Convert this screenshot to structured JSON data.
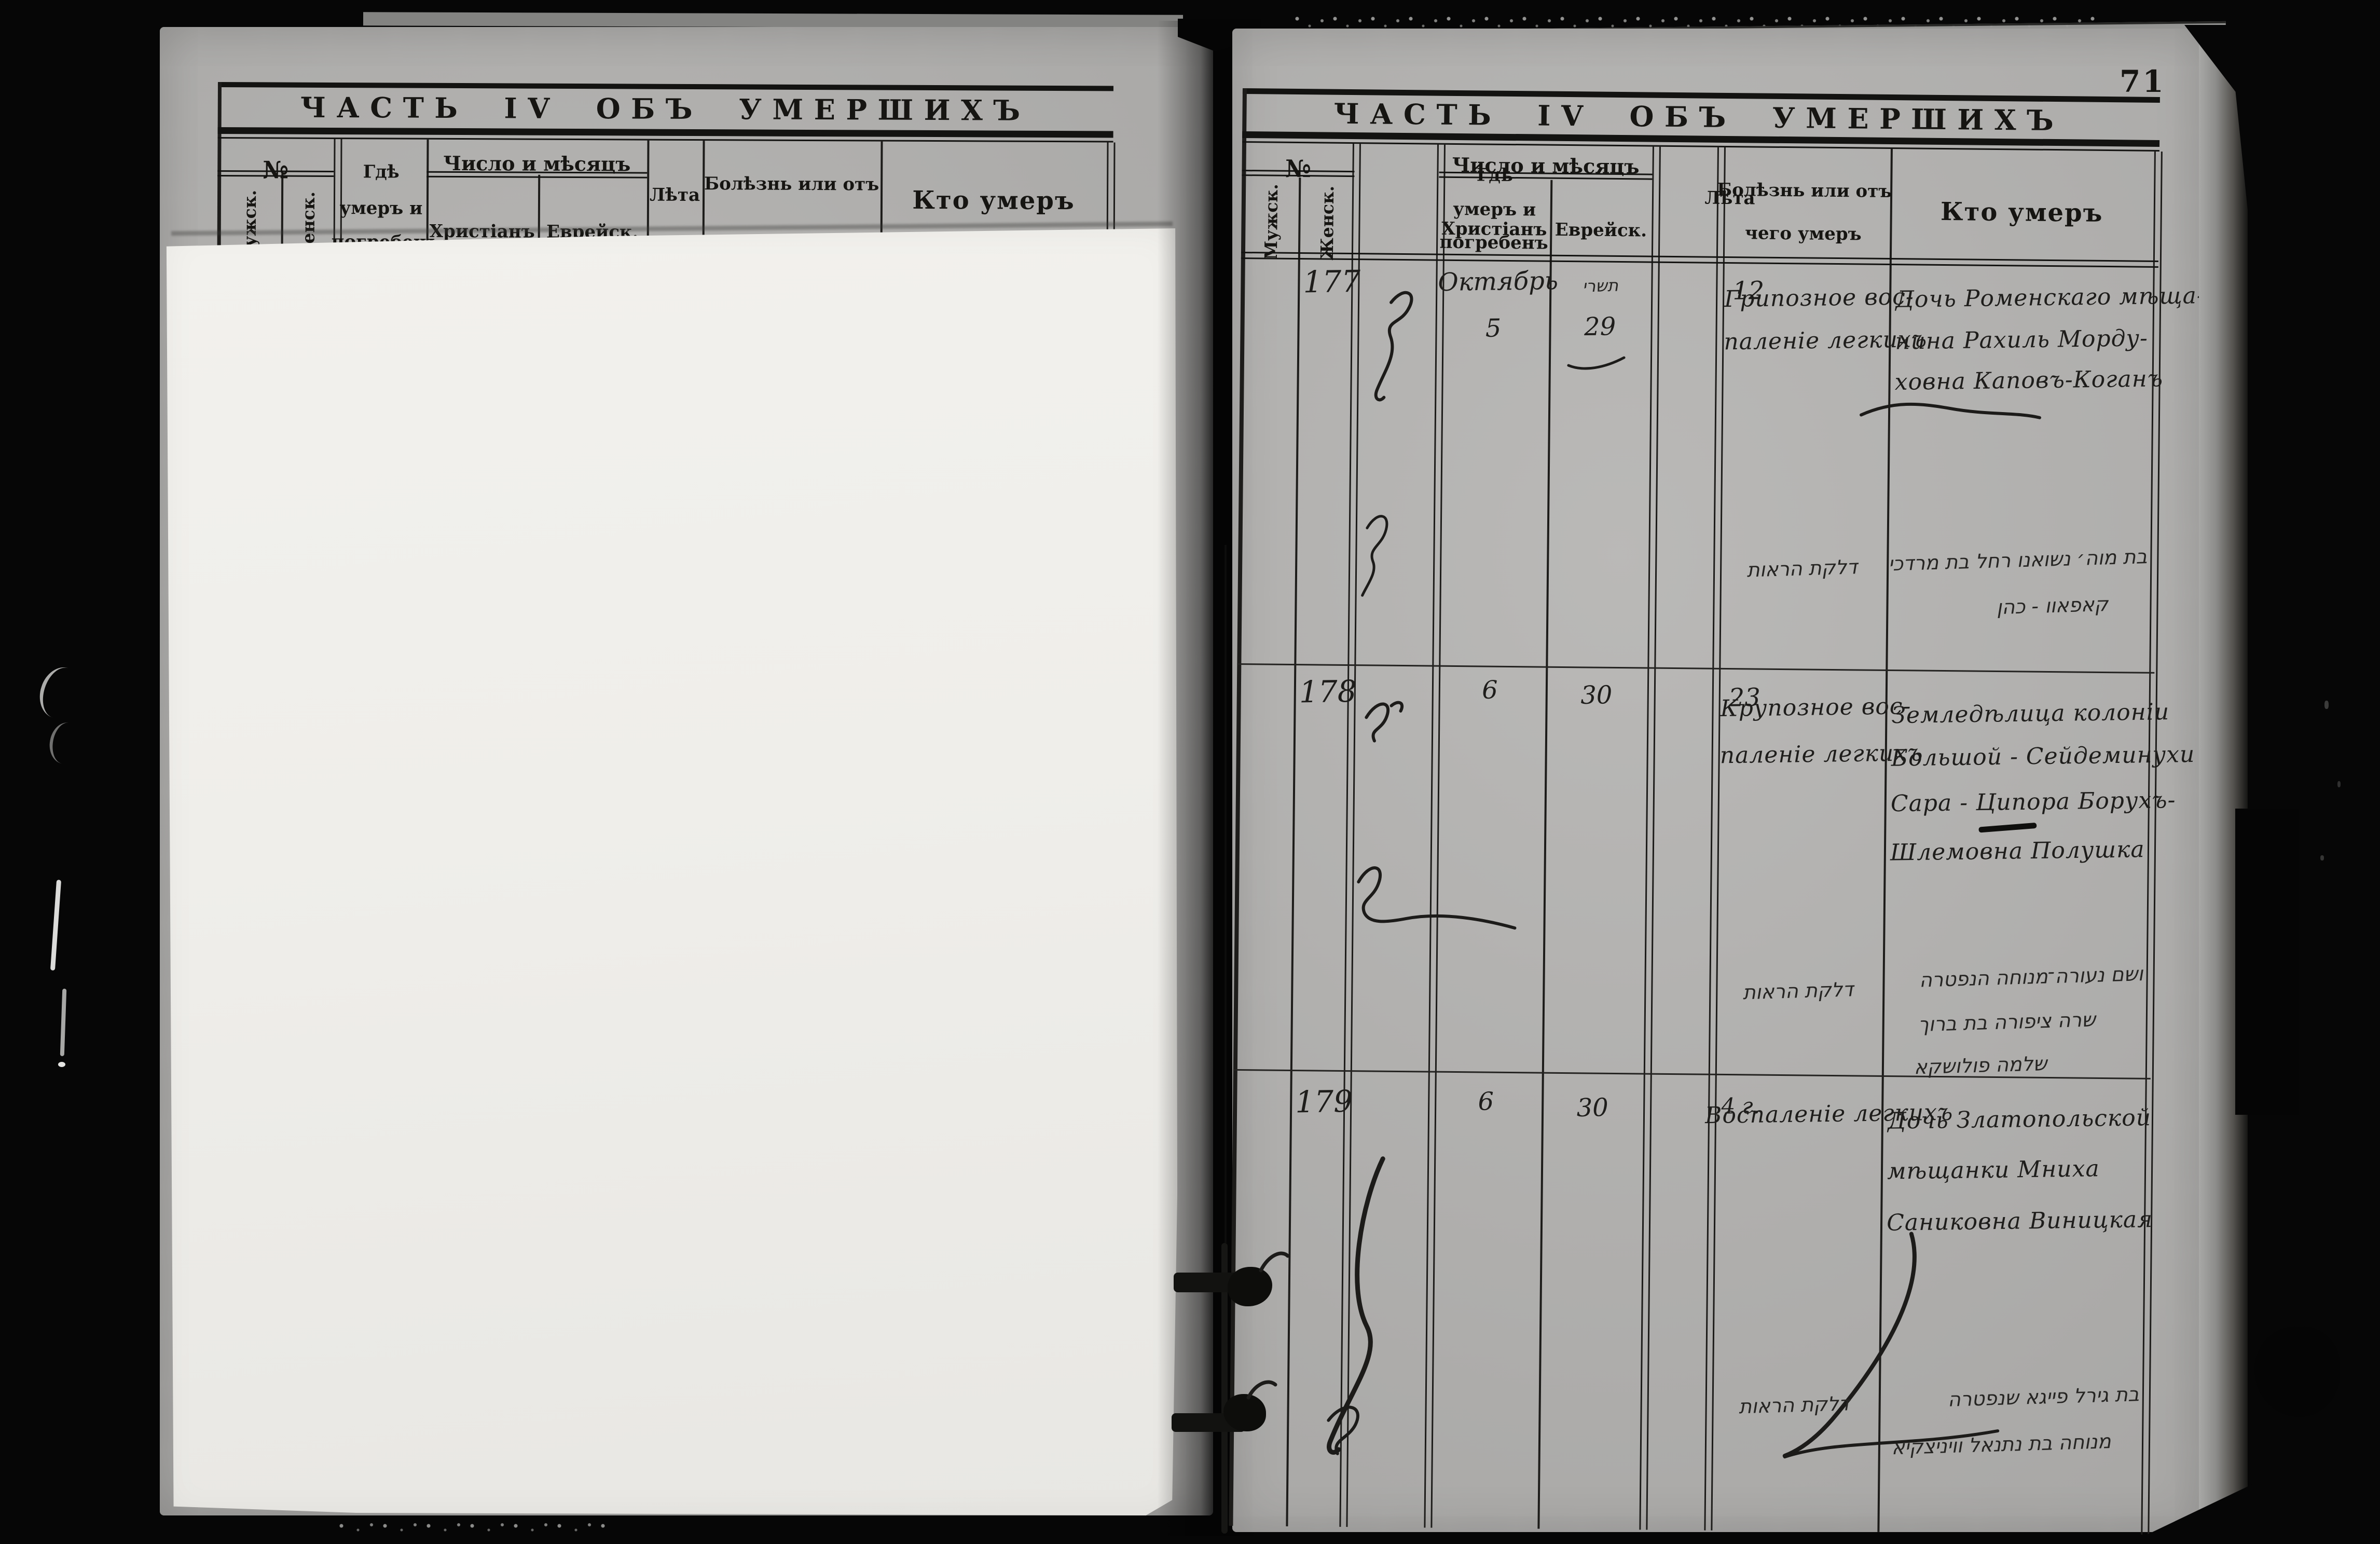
{
  "page": {
    "folio": "71"
  },
  "colors": {
    "paper": "#b5b4b2",
    "sheet": "#f0efeb",
    "ink": "#1e1d1b",
    "print": "#141412",
    "background": "#060606"
  },
  "headers": {
    "title": "ЧАСТЬ IV ОБЪ УМЕРШИХЪ",
    "no": "№",
    "male": "Мужск.",
    "female": "Женск.",
    "where": [
      "Гдѣ",
      "умеръ и",
      "погребенъ"
    ],
    "date_group": "Число и мѣсяцъ",
    "christian": "Христіанъ",
    "jewish": "Еврейск.",
    "age": "Лѣта",
    "disease": [
      "Болѣзнь или отъ",
      "чего умеръ"
    ],
    "who": "Кто умеръ"
  },
  "entries": [
    {
      "number": "177",
      "month_christian": "Октябрь",
      "day_christian": "5",
      "month_jewish": "תשרי",
      "day_jewish": "29",
      "age": "12",
      "disease": [
        "Грипозное вос-",
        "паленіе легкихъ"
      ],
      "who": [
        "Дочь Роменскаго мѣща-",
        "нина Рахиль Морду-",
        "ховна Каповъ-Коганъ"
      ],
      "hebrew_disease": "דלקת הראות",
      "hebrew_note": [
        "בת מוה׳ נשואנו רחל בת מרדכי",
        "קאפאוו - כהן"
      ]
    },
    {
      "number": "178",
      "day_christian": "6",
      "day_jewish": "30",
      "age": "23",
      "disease": [
        "Крупозное вос-",
        "паленіе легкихъ"
      ],
      "who": [
        "Земледѣлица колоніи",
        "Большой - Сейдеминухи",
        "Сара - Ципора Борухъ-",
        "Шлемовна Полушка"
      ],
      "hebrew_disease": "דלקת הראות",
      "hebrew_note": [
        "ושם נעורה־מנוחה הנפטרה",
        "שרה ציפורה בת ברוך",
        "שלמה פולושקא"
      ]
    },
    {
      "number": "179",
      "day_christian": "6",
      "day_jewish": "30",
      "age": "4 г.",
      "disease": [
        "Воспаленіе легкихъ"
      ],
      "who": [
        "Дочь Златопольской",
        "мѣщанки Мниха",
        "Саниковна Виницкая"
      ],
      "hebrew_disease": "דלקת הראות",
      "hebrew_note": [
        "בת גירל פייגא שנפטרה",
        "מנוחה בת נתנאל וויניצקיא"
      ]
    }
  ]
}
